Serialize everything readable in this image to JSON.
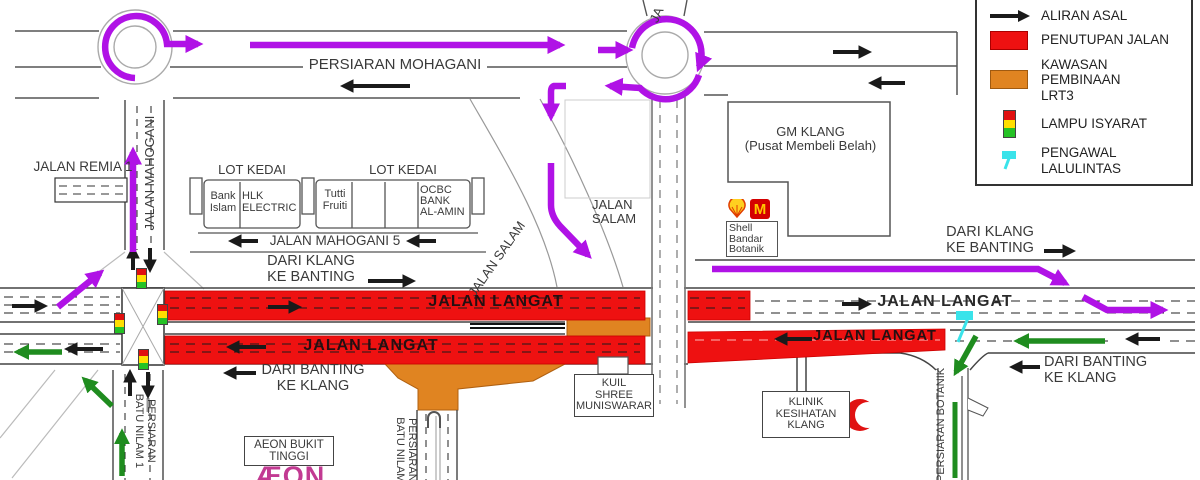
{
  "title": "Pelan lencongan trafik LRT3 - Jalan Langat / Bandar Botanik Klang",
  "legend": {
    "items": [
      {
        "icon": "black-arrow",
        "label": "ALIRAN ASAL"
      },
      {
        "icon": "red-swatch",
        "label": "PENUTUPAN JALAN"
      },
      {
        "icon": "orange-swatch",
        "label": "KAWASAN PEMBINAAN\nLRT3"
      },
      {
        "icon": "traffic-light",
        "label": "LAMPU ISYARAT"
      },
      {
        "icon": "cyan-flag",
        "label": "PENGAWAL\nLALULINTAS"
      }
    ]
  },
  "roads": {
    "persiaran_mohagani": "PERSIARAN MOHAGANI",
    "jalan_remia_1": "JALAN REMIA 1",
    "jalan_mahogani": "JALAN MAHOGANI",
    "jalan_mahogani_5": "JALAN MAHOGANI 5",
    "jalan_top_cut": "JA",
    "jalan_salam_diag": "JALAN SALAM",
    "jalan_salam": "JALAN\nSALAM",
    "jalan_langat": "JALAN LANGAT",
    "persiaran_batu_nilam_1": "PERSIARAN\nBATU NILAM 1",
    "persiaran_batu_nilam": "PERSIARAN\nBATU NILAM",
    "persiaran_botanik": "PERSIARAN BOTANIK"
  },
  "directions": {
    "dari_klang_ke_banting": "DARI KLANG\nKE BANTING",
    "dari_banting_ke_klang": "DARI BANTING\nKE KLANG"
  },
  "shops": {
    "lot_kedai": "LOT KEDAI",
    "lot1": [
      "Bank\nIslam",
      "HLK\nELECTRIC"
    ],
    "lot2": [
      "Tutti\nFruiti",
      "OCBC\nBANK\nAL-AMIN"
    ]
  },
  "landmarks": {
    "gm_klang": "GM KLANG\n(Pusat Membeli Belah)",
    "shell": "Shell\nBandar\nBotanik",
    "mcd": "M",
    "kuil": "KUIL\nSHREE\nMUNISWARAR",
    "klinik": "KLINIK\nKESIHATAN\nKLANG",
    "aeon_box": "AEON BUKIT\nTINGGI",
    "aeon_logo": "ÆON"
  },
  "colors": {
    "road_closure": "#ee1111",
    "lrt3_construction": "#e08421",
    "diversion_route": "#b012e6",
    "original_flow": "#1a1a1a",
    "secondary_route": "#1f8c1f",
    "traffic_controller": "#3ae3ea"
  }
}
